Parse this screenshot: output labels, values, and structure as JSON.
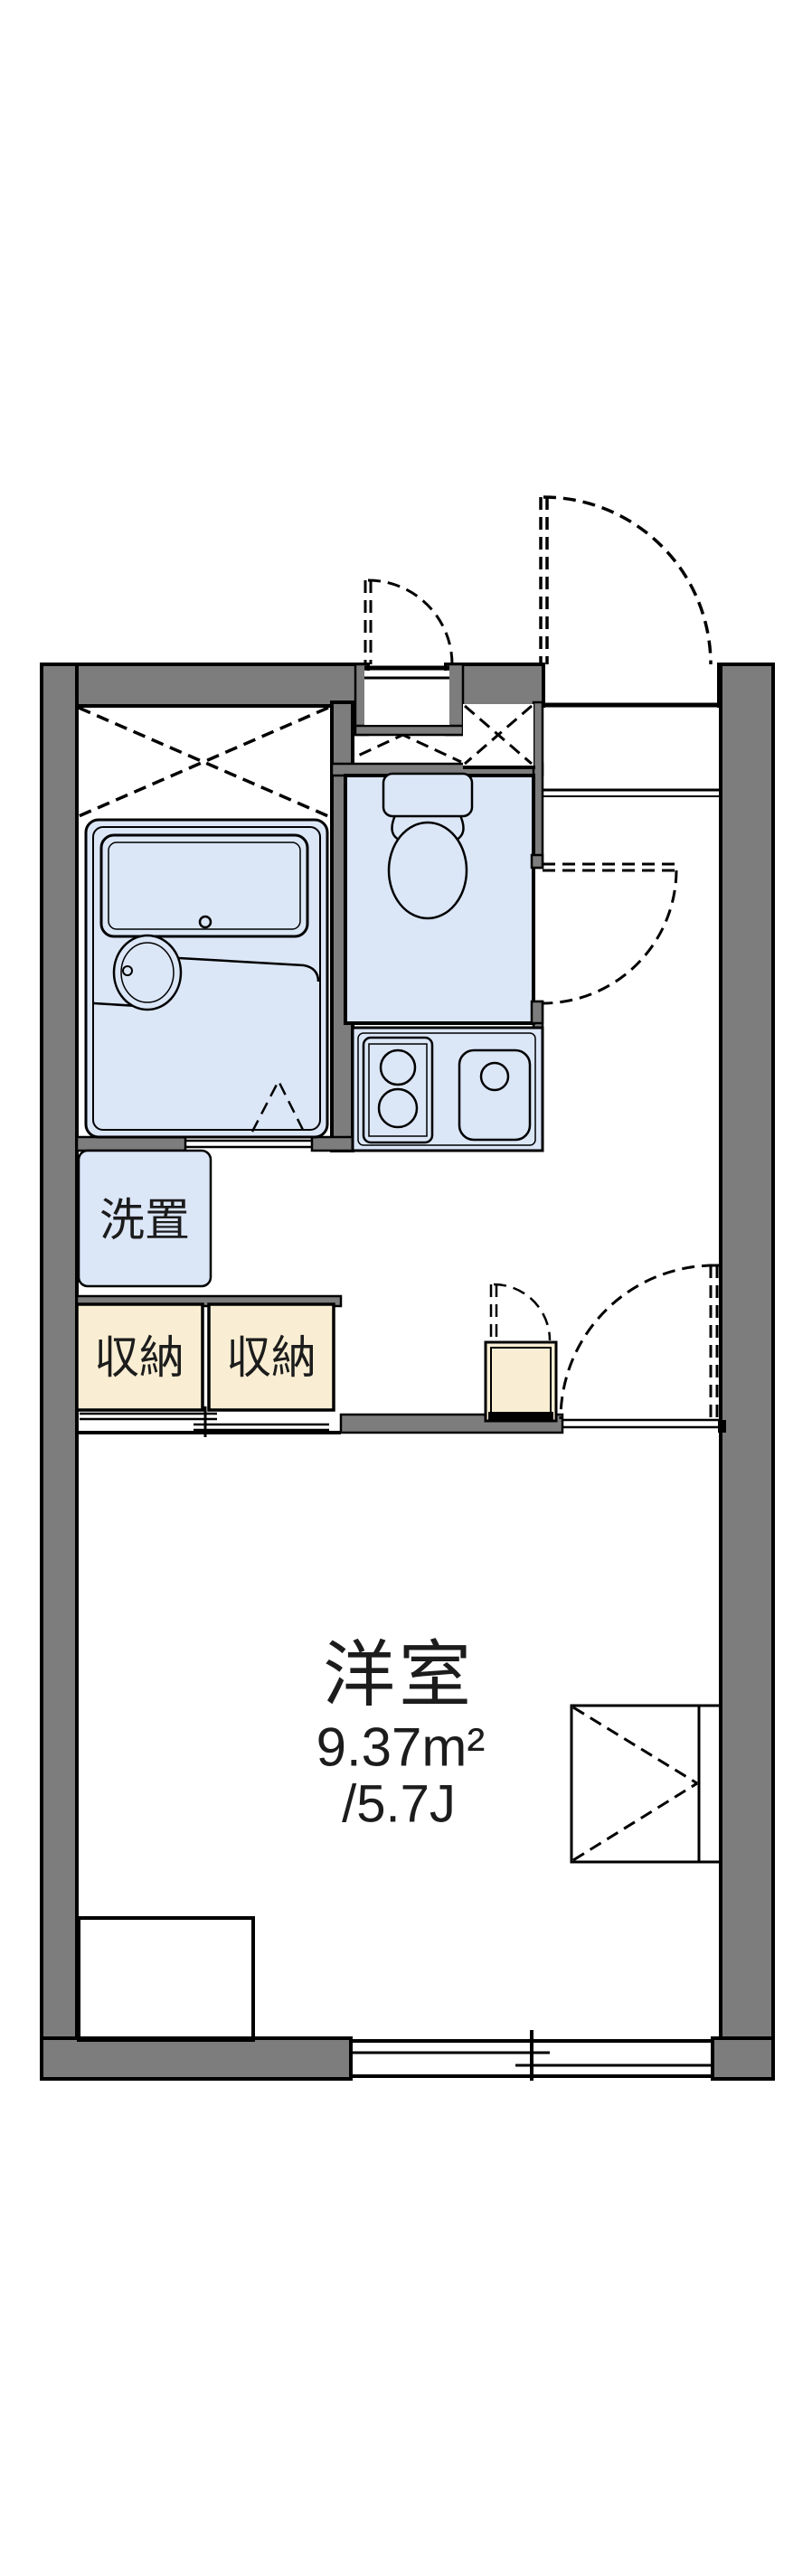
{
  "colors": {
    "bg": "#ffffff",
    "wall": "#7d7d7d",
    "fixture": "#dbe6f7",
    "storage": "#f9eed3",
    "line": "#000000",
    "text": "#1c1c1c"
  },
  "plan": {
    "main_room": {
      "name": "洋室",
      "area": "9.37m²",
      "tatami": "/5.7J"
    },
    "washer_label": "洗置",
    "storage1_label": "収納",
    "storage2_label": "収納"
  }
}
